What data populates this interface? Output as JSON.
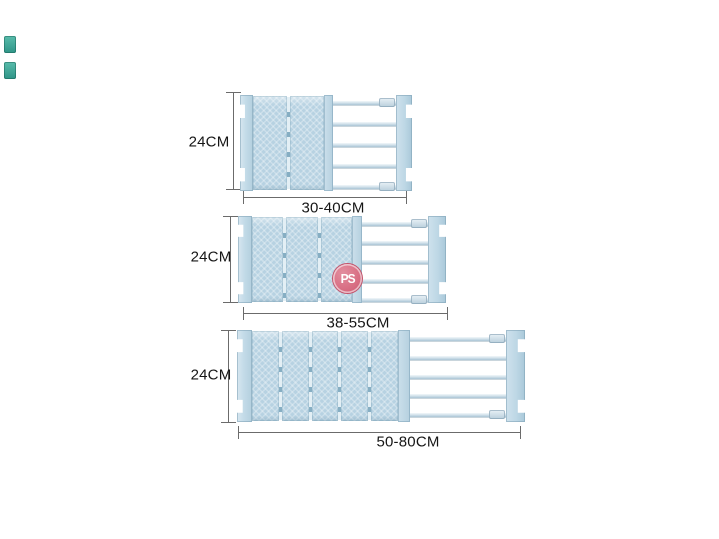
{
  "diagram": {
    "title_semantic": "adjustable-closet-shelf-divider-size-chart",
    "watermark": {
      "text": "PS",
      "background": "#d97085",
      "ring": "#c4526a",
      "text_color": "#ffffff"
    },
    "shelves": [
      {
        "name": "shelf-small",
        "height_label": "24CM",
        "width_label": "30-40CM",
        "panel_count": 2,
        "rod_count": 5
      },
      {
        "name": "shelf-medium",
        "height_label": "24CM",
        "width_label": "38-55CM",
        "panel_count": 3,
        "rod_count": 5
      },
      {
        "name": "shelf-large",
        "height_label": "24CM",
        "width_label": "50-80CM",
        "panel_count": 5,
        "rod_count": 5
      }
    ],
    "colors": {
      "panel": "#b7d2e2",
      "end_cap": "#c3dbe8",
      "rod": "#d4e3ec",
      "dimension_line": "#6b6b6b",
      "label_text": "#161616",
      "background": "#ffffff"
    }
  }
}
